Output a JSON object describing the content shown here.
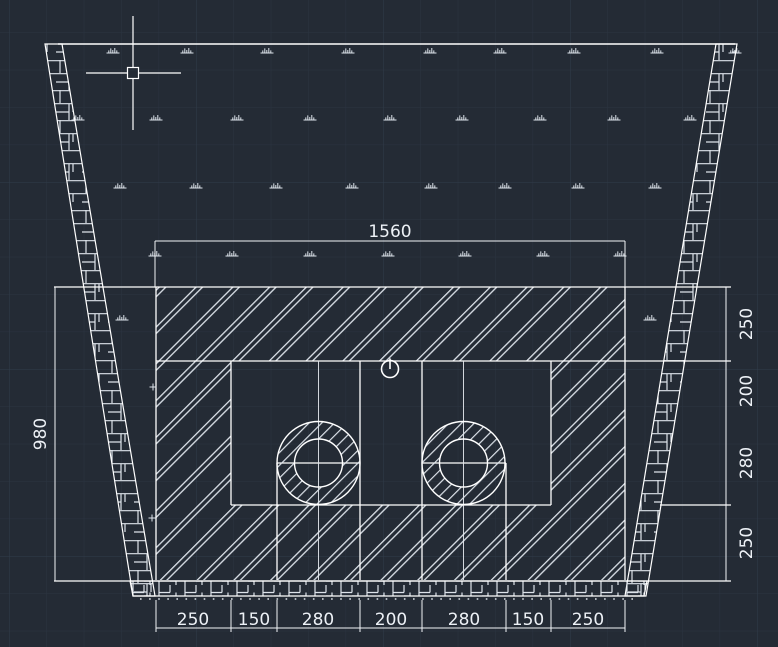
{
  "app": {
    "name": "CAD model space",
    "view": "culvert cross-section drawing"
  },
  "canvas": {
    "background": "#242b35",
    "grid_minor": "#2b3441",
    "grid_major": "#313c4a",
    "line_color": "#ffffff",
    "text_color": "#edf1f6"
  },
  "drawing": {
    "dimensions": {
      "top_width": "1560",
      "left_height": "980",
      "right_chain": [
        "250",
        "200",
        "280",
        "250"
      ],
      "bottom_chain": [
        "250",
        "150",
        "280",
        "200",
        "280",
        "150",
        "250"
      ]
    },
    "grass_rows": [
      {
        "y": 53,
        "x": [
          113,
          187,
          267,
          348,
          430,
          500,
          574,
          657,
          735
        ]
      },
      {
        "y": 120,
        "x": [
          78,
          156,
          237,
          310,
          390,
          462,
          540,
          614,
          690
        ]
      },
      {
        "y": 188,
        "x": [
          120,
          196,
          276,
          352,
          431,
          505,
          578,
          655
        ]
      },
      {
        "y": 256,
        "x": [
          155,
          232,
          310,
          388,
          465,
          543,
          620
        ]
      },
      {
        "y": 320,
        "x": [
          122,
          650
        ]
      }
    ]
  }
}
